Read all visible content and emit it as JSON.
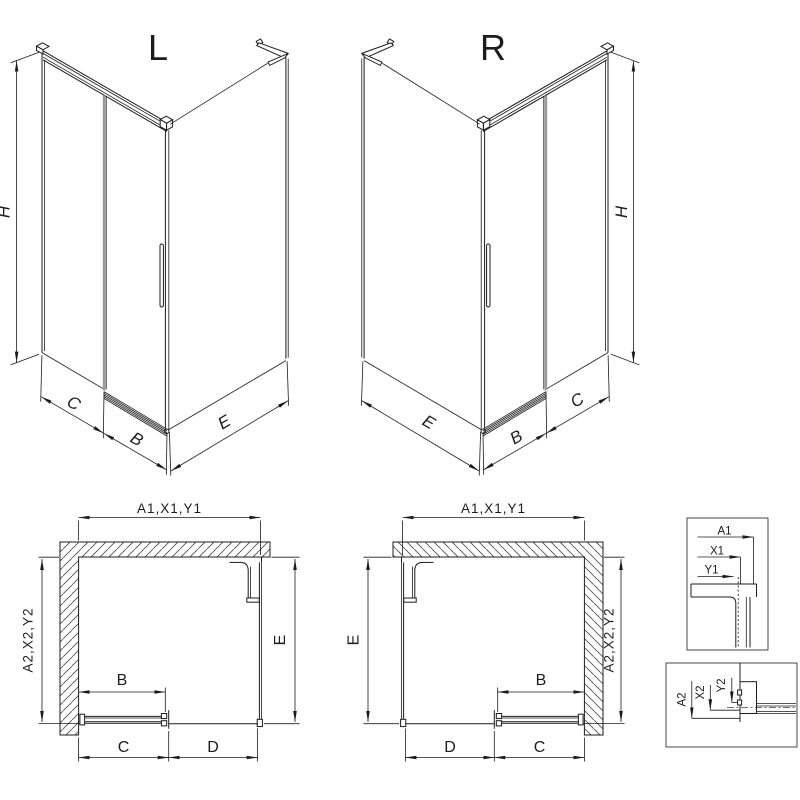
{
  "colors": {
    "line": "#1c1c1c",
    "glass": "#9a9a9a",
    "background": "#ffffff"
  },
  "iso_left": {
    "label": "L",
    "dim_height": "H",
    "dim_fixed": "C",
    "dim_door": "B",
    "dim_side": "E"
  },
  "iso_right": {
    "label": "R",
    "dim_height": "H",
    "dim_side": "E",
    "dim_door": "B",
    "dim_fixed": "C"
  },
  "plan_left": {
    "dim_width": "A1,X1,Y1",
    "dim_depth": "A2,X2,Y2",
    "dim_side": "E",
    "dim_door": "B",
    "dim_fixed": "C",
    "dim_open": "D"
  },
  "plan_right": {
    "dim_width": "A1,X1,Y1",
    "dim_depth": "A2,X2,Y2",
    "dim_side": "E",
    "dim_door": "B",
    "dim_open": "D",
    "dim_fixed": "C"
  },
  "detail_top": {
    "dim_a": "A1",
    "dim_x": "X1",
    "dim_y": "Y1"
  },
  "detail_bottom": {
    "dim_a": "A2",
    "dim_x": "X2",
    "dim_y": "Y2"
  }
}
